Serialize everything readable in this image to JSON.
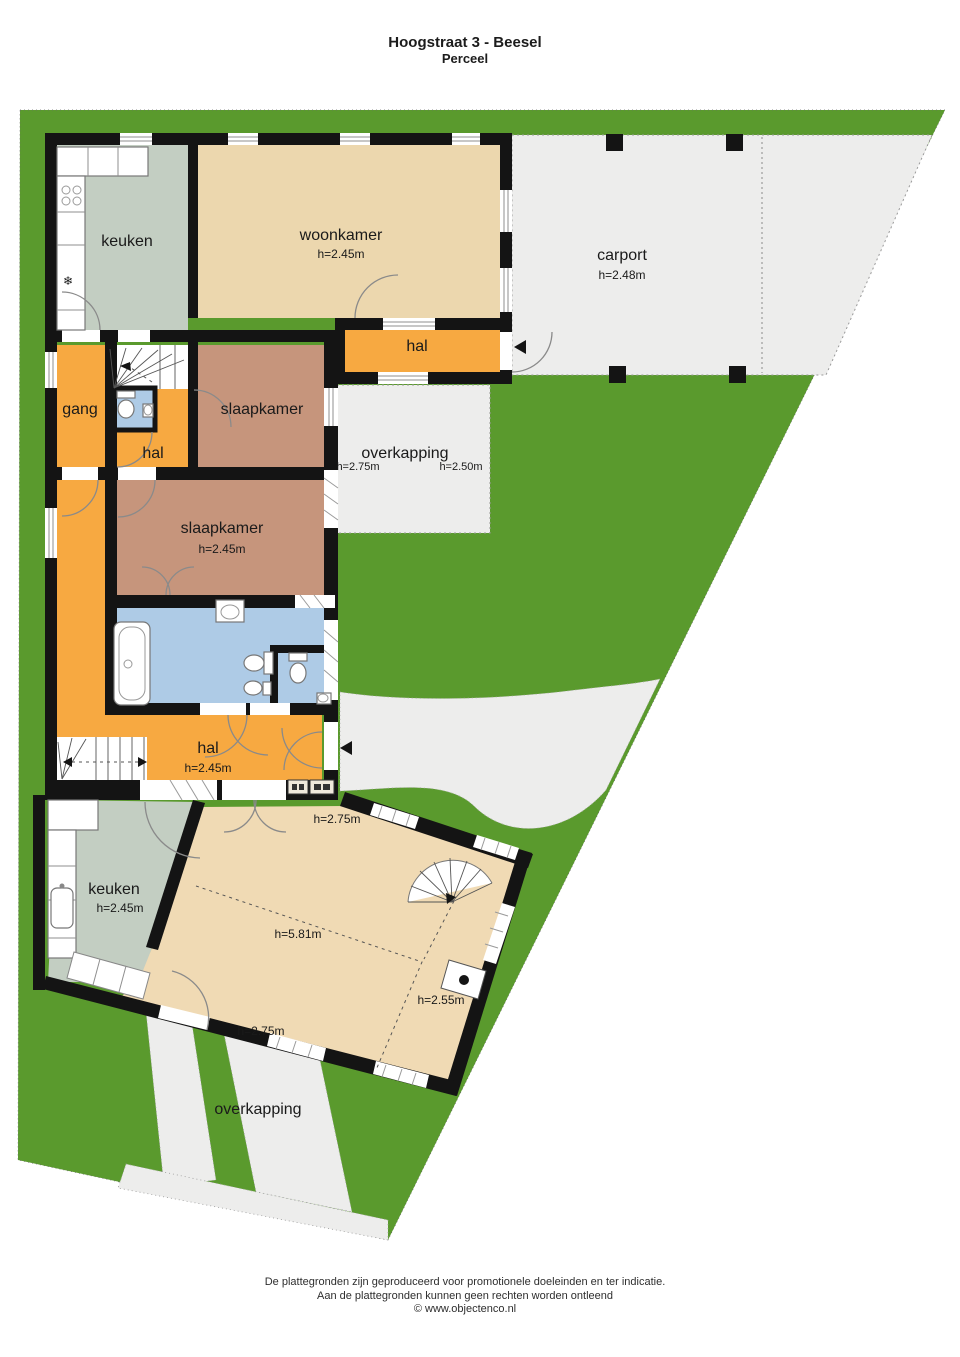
{
  "title": {
    "line1": "Hoogstraat 3 - Beesel",
    "line2": "Perceel"
  },
  "floors": {
    "keuken_top": {
      "label": "keuken"
    },
    "woonkamer": {
      "label": "woonkamer",
      "height": "h=2.45m"
    },
    "carport": {
      "label": "carport",
      "height": "h=2.48m"
    },
    "hal_top": {
      "label": "hal"
    },
    "gang": {
      "label": "gang"
    },
    "hal_mid": {
      "label": "hal"
    },
    "slaapkamer_voor": {
      "label": "slaapkamer"
    },
    "overkapping_boven": {
      "label": "overkapping",
      "height_left": "h=2.75m",
      "height_right": "h=2.50m"
    },
    "slaapkamer_achter": {
      "label": "slaapkamer",
      "height": "h=2.45m"
    },
    "hal_beneden": {
      "label": "hal",
      "height": "h=2.45m"
    },
    "keuken_beneden": {
      "label": "keuken",
      "height": "h=2.45m"
    },
    "bijgebouw": {
      "height_top": "h=2.75m",
      "height_main": "h=5.81m",
      "height_side": "h=2.55m",
      "height_bottom": "h=2.75m"
    },
    "overkapping_onder": {
      "label": "overkapping"
    }
  },
  "footer": {
    "line1": "De plattegronden zijn geproduceerd voor promotionele doeleinden en ter indicatie.",
    "line2": "Aan de plattegronden kunnen geen rechten worden ontleend",
    "line3": "© www.objectenco.nl"
  },
  "colors": {
    "grass": "#5a9a2d",
    "pavement": "#ededec",
    "hall": "#f7a941",
    "living": "#ecd7ae",
    "annex": "#f0dab4",
    "bedroom": "#c6957c",
    "kitchen": "#c3cec2",
    "bathroom": "#aecbe6",
    "wall": "#141414"
  }
}
